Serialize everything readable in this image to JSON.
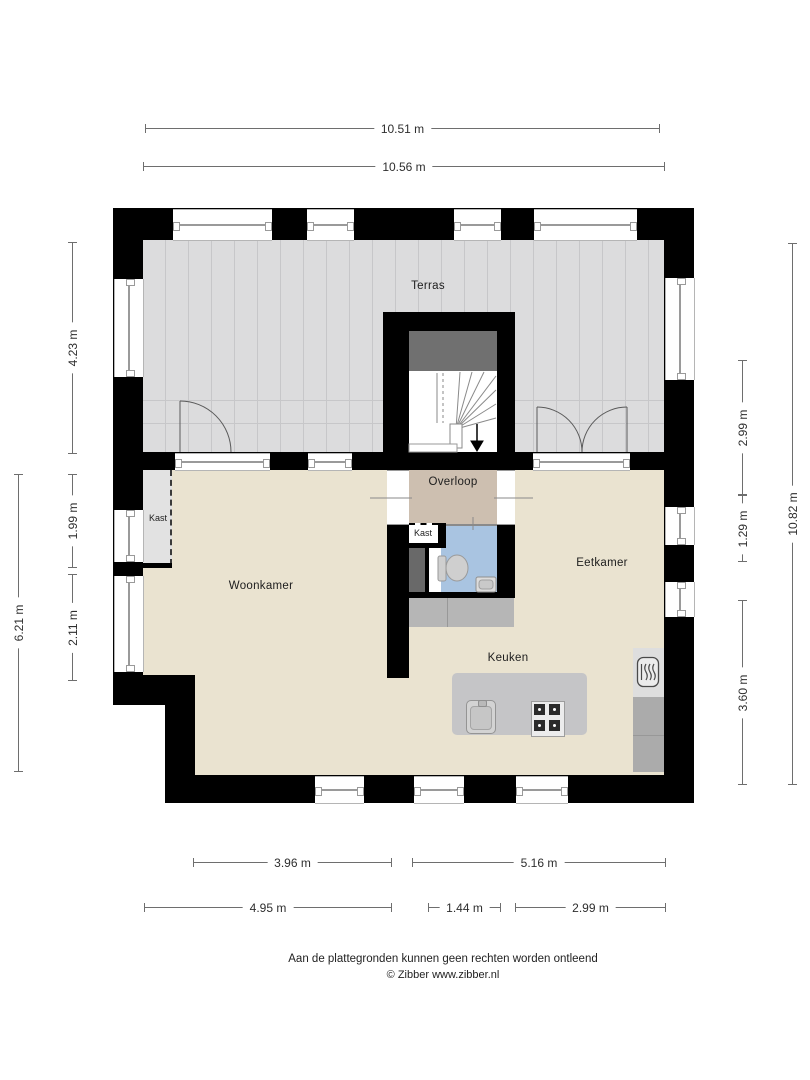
{
  "rooms": {
    "terras": "Terras",
    "woonkamer": "Woonkamer",
    "eetkamer": "Eetkamer",
    "keuken": "Keuken",
    "overloop": "Overloop",
    "kast_left": "Kast",
    "kast_mid": "Kast"
  },
  "dimensions": {
    "top": [
      {
        "label": "10.51 m"
      },
      {
        "label": "10.56 m"
      }
    ],
    "left_outer": {
      "label": "6.21 m"
    },
    "left_inner": [
      {
        "label": "4.23 m"
      },
      {
        "label": "1.99 m"
      },
      {
        "label": "2.11 m"
      }
    ],
    "right_inner": [
      {
        "label": "2.99 m"
      },
      {
        "label": "1.29 m"
      },
      {
        "label": "3.60 m"
      }
    ],
    "right_outer": {
      "label": "10.82 m"
    },
    "bottom_upper": [
      {
        "label": "3.96 m"
      },
      {
        "label": "5.16 m"
      }
    ],
    "bottom_lower": [
      {
        "label": "4.95 m"
      },
      {
        "label": "1.44 m"
      },
      {
        "label": "2.99 m"
      }
    ]
  },
  "footer": {
    "disclaimer": "Aan de plattegronden kunnen geen rechten worden ontleend",
    "credit": "© Zibber www.zibber.nl"
  },
  "colors": {
    "wall": "#000000",
    "terras": "#dcdcdd",
    "terras_line": "#c7c7c9",
    "floor": "#eae3d0",
    "overloop": "#cdbfb0",
    "bathroom": "#a9c4e1",
    "landing": "#707070",
    "closet_light": "#e2e2e2",
    "closet_dark": "#696969",
    "counter": "#b6b6b6",
    "counter_right": "#ababab",
    "island": "#c5c5c7",
    "oven_panel": "#dedede"
  }
}
